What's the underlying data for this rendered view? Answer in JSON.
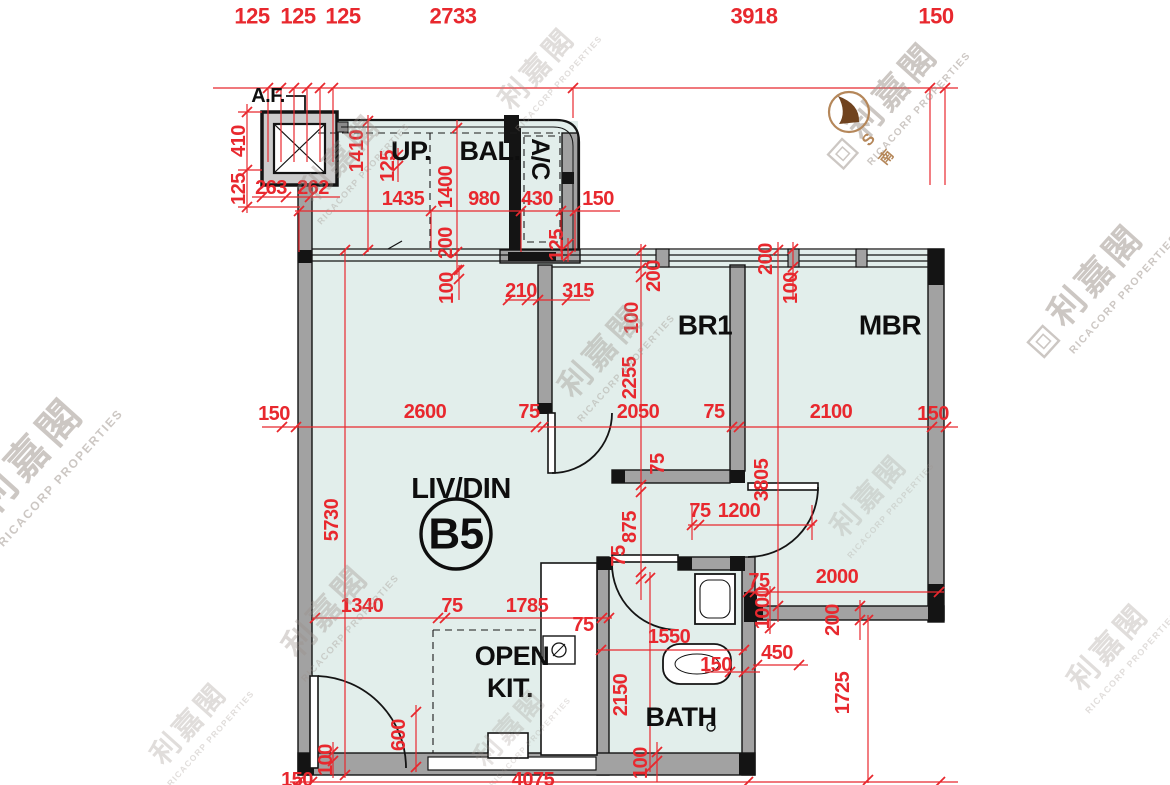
{
  "document": {
    "type": "floor-plan",
    "unit": "B5"
  },
  "unit_badge": {
    "label": "B5",
    "cx": 456,
    "cy": 534,
    "r": 35
  },
  "rooms": [
    {
      "label": "A.F.",
      "x": 268,
      "y": 96,
      "s": 20
    },
    {
      "label": "UP.",
      "x": 411,
      "y": 151,
      "s": 27
    },
    {
      "label": "BAL.",
      "x": 490,
      "y": 151,
      "s": 27
    },
    {
      "label": "A/C",
      "x": 540,
      "y": 159,
      "r": 90,
      "s": 25
    },
    {
      "label": "BR1",
      "x": 705,
      "y": 325,
      "s": 28
    },
    {
      "label": "MBR",
      "x": 890,
      "y": 325,
      "s": 28
    },
    {
      "label": "LIV/DIN",
      "x": 461,
      "y": 489,
      "s": 29
    },
    {
      "label": "OPEN",
      "x": 512,
      "y": 656,
      "s": 27
    },
    {
      "label": "KIT.",
      "x": 510,
      "y": 688,
      "s": 27
    },
    {
      "label": "BATH",
      "x": 681,
      "y": 717,
      "s": 27
    }
  ],
  "dimensions": [
    {
      "t": "125",
      "x": 252,
      "y": 16,
      "s": 22
    },
    {
      "t": "125",
      "x": 298,
      "y": 16,
      "s": 22
    },
    {
      "t": "125",
      "x": 343,
      "y": 16,
      "s": 22
    },
    {
      "t": "2733",
      "x": 453,
      "y": 16,
      "s": 22
    },
    {
      "t": "3918",
      "x": 754,
      "y": 16,
      "s": 22
    },
    {
      "t": "150",
      "x": 936,
      "y": 16,
      "s": 22
    },
    {
      "t": "410",
      "x": 239,
      "y": 141,
      "r": -90
    },
    {
      "t": "125",
      "x": 239,
      "y": 189,
      "r": -90
    },
    {
      "t": "263",
      "x": 271,
      "y": 188
    },
    {
      "t": "262",
      "x": 313,
      "y": 188
    },
    {
      "t": "1435",
      "x": 403,
      "y": 199
    },
    {
      "t": "980",
      "x": 484,
      "y": 199
    },
    {
      "t": "430",
      "x": 537,
      "y": 199
    },
    {
      "t": "150",
      "x": 598,
      "y": 199
    },
    {
      "t": "1410",
      "x": 357,
      "y": 151,
      "r": -90
    },
    {
      "t": "125",
      "x": 388,
      "y": 166,
      "r": -90
    },
    {
      "t": "1400",
      "x": 446,
      "y": 187,
      "r": -90
    },
    {
      "t": "200",
      "x": 446,
      "y": 243,
      "r": -90
    },
    {
      "t": "125",
      "x": 557,
      "y": 245,
      "r": -90
    },
    {
      "t": "100",
      "x": 447,
      "y": 288,
      "r": -90
    },
    {
      "t": "210",
      "x": 521,
      "y": 291
    },
    {
      "t": "315",
      "x": 578,
      "y": 291
    },
    {
      "t": "200",
      "x": 654,
      "y": 276,
      "r": -90
    },
    {
      "t": "100",
      "x": 632,
      "y": 318,
      "r": -90
    },
    {
      "t": "200",
      "x": 766,
      "y": 259,
      "r": -90
    },
    {
      "t": "100",
      "x": 791,
      "y": 288,
      "r": -90
    },
    {
      "t": "2255",
      "x": 630,
      "y": 378,
      "r": -90
    },
    {
      "t": "150",
      "x": 274,
      "y": 414
    },
    {
      "t": "2600",
      "x": 425,
      "y": 412
    },
    {
      "t": "75",
      "x": 529,
      "y": 412
    },
    {
      "t": "2050",
      "x": 638,
      "y": 412
    },
    {
      "t": "75",
      "x": 714,
      "y": 412
    },
    {
      "t": "2100",
      "x": 831,
      "y": 412
    },
    {
      "t": "150",
      "x": 933,
      "y": 414
    },
    {
      "t": "75",
      "x": 658,
      "y": 464,
      "r": -90
    },
    {
      "t": "875",
      "x": 630,
      "y": 527,
      "r": -90
    },
    {
      "t": "75",
      "x": 619,
      "y": 556,
      "r": -90
    },
    {
      "t": "3805",
      "x": 762,
      "y": 480,
      "r": -90
    },
    {
      "t": "5730",
      "x": 332,
      "y": 520,
      "r": -90
    },
    {
      "t": "75",
      "x": 700,
      "y": 511
    },
    {
      "t": "1200",
      "x": 739,
      "y": 511
    },
    {
      "t": "1340",
      "x": 362,
      "y": 606
    },
    {
      "t": "75",
      "x": 452,
      "y": 606
    },
    {
      "t": "1785",
      "x": 527,
      "y": 606
    },
    {
      "t": "75",
      "x": 583,
      "y": 625
    },
    {
      "t": "1550",
      "x": 669,
      "y": 637
    },
    {
      "t": "150",
      "x": 716,
      "y": 665
    },
    {
      "t": "450",
      "x": 777,
      "y": 653
    },
    {
      "t": "75",
      "x": 759,
      "y": 581
    },
    {
      "t": "1000",
      "x": 763,
      "y": 608,
      "r": -90
    },
    {
      "t": "2150",
      "x": 621,
      "y": 695,
      "r": -90
    },
    {
      "t": "2000",
      "x": 837,
      "y": 577
    },
    {
      "t": "200",
      "x": 833,
      "y": 620,
      "r": -90
    },
    {
      "t": "1725",
      "x": 843,
      "y": 693,
      "r": -90
    },
    {
      "t": "600",
      "x": 399,
      "y": 735,
      "r": -90
    },
    {
      "t": "100",
      "x": 326,
      "y": 760,
      "r": -90
    },
    {
      "t": "100",
      "x": 641,
      "y": 763,
      "r": -90
    },
    {
      "t": "150",
      "x": 297,
      "y": 780
    },
    {
      "t": "4075",
      "x": 533,
      "y": 780
    }
  ],
  "compass": {
    "s_label": "S",
    "south_label": "南"
  },
  "watermark": {
    "cjk": "利嘉閣",
    "latin": "RICACORP PROPERTIES"
  },
  "colors": {
    "dimension_red": "#e8282e",
    "wall_dark": "#141414",
    "wall_fill": "#a2a2a2",
    "floor_fill": "#e2eeeb",
    "watermark_gray": "#9b9089",
    "compass_tan": "#b5875a"
  }
}
